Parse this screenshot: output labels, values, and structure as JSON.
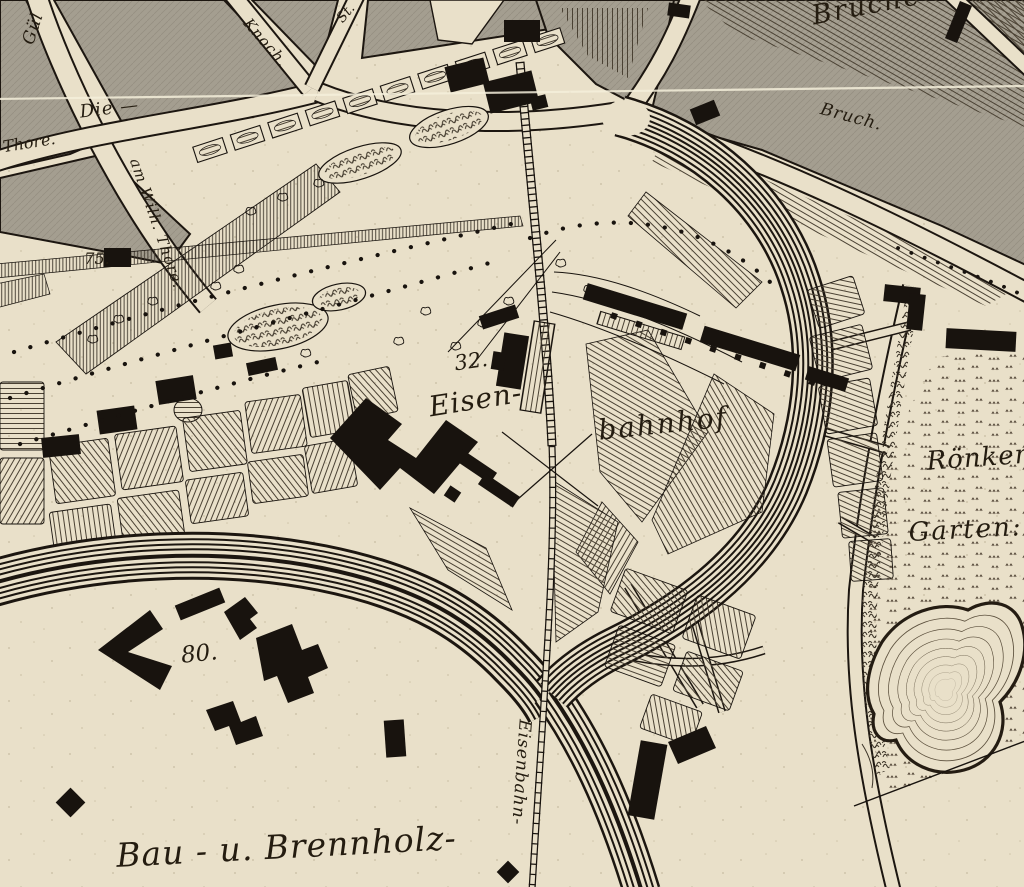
{
  "map": {
    "description": "Engraved historical town map detail with railway station",
    "colors": {
      "paper": "#e9e0c9",
      "ink": "#18130e",
      "casing": "#1c1610",
      "gray_block": "#a49e90",
      "gray_hatch": "#968f81",
      "field_hatch": "#4a4133",
      "fine_hatch": "#3d362b",
      "contour": "#5c503d",
      "meadow_mark": "#55493a",
      "fold_line": "#f4eedb"
    },
    "labels": {
      "guel": {
        "text": "Gül"
      },
      "knoch": {
        "text": "Knoch."
      },
      "st": {
        "text": "St."
      },
      "die": {
        "text": "Die —"
      },
      "thore": {
        "text": "Thore."
      },
      "wilhthore": {
        "text": "am Wilh. Thore."
      },
      "n75": {
        "text": "75."
      },
      "brueche": {
        "text": "Brüche"
      },
      "bruch": {
        "text": "Bruch."
      },
      "n32": {
        "text": "32."
      },
      "eisen": {
        "text": "Eisen-"
      },
      "bahnhof": {
        "text": "bahnhof"
      },
      "roenken": {
        "text": "Rönken"
      },
      "garten": {
        "text": "Garten:"
      },
      "n80": {
        "text": "80."
      },
      "bau": {
        "text": "Bau - u. Brennholz-"
      },
      "eisenbahn": {
        "text": "Eisenbahn-"
      }
    }
  }
}
